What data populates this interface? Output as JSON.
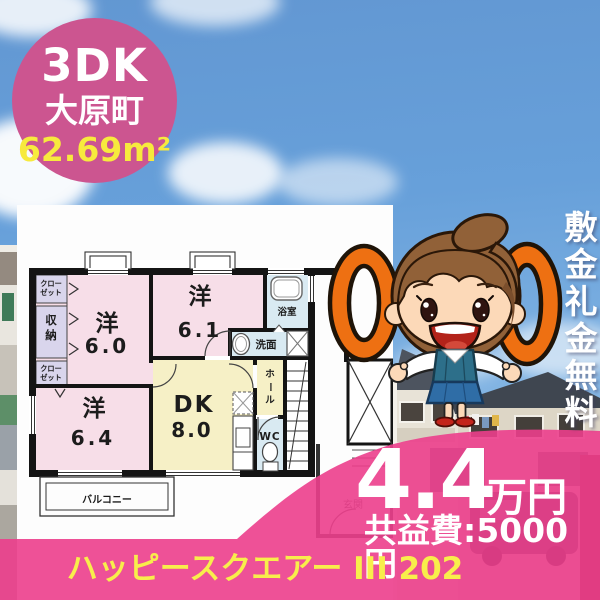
{
  "badge": {
    "layout": "3DK",
    "town": "大原町",
    "area": "62.69m²"
  },
  "ribbon": {
    "text": "敷金礼金無料"
  },
  "zero_symbols": [
    "0",
    "0"
  ],
  "price": {
    "rent": "4.4",
    "unit": "万円",
    "common_fee": "共益費:5000円"
  },
  "footer": {
    "property_name": "ハッピースクエアー III 202"
  },
  "floorplan": {
    "room_west1": {
      "label": "洋",
      "size": "6.0"
    },
    "room_west2": {
      "label": "洋",
      "size": "6.1"
    },
    "room_west3": {
      "label": "洋",
      "size": "6.4"
    },
    "dk": {
      "label": "DK",
      "size": "8.0"
    },
    "closet": "クローゼット",
    "storage": "収納",
    "bathroom": "浴室",
    "washroom": "洗面",
    "hall": "ホール",
    "toilet": "WC",
    "balcony": "バルコニー",
    "entrance": "玄関"
  },
  "colors": {
    "accent_pink": "#ec3e8c",
    "badge_pink": "#cc5590",
    "accent_yellow": "#f8ee4b",
    "zero_orange": "#ee7012"
  }
}
